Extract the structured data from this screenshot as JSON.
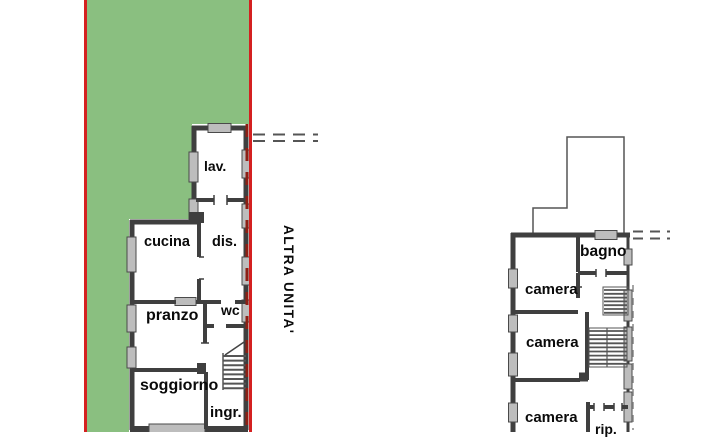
{
  "scene": {
    "description": "real-estate cadastral floor plan drawing, two storeys",
    "colors": {
      "parcel_green": "#8abf80",
      "boundary_red": "#d42020",
      "boundary_dashes_dark_red": "#8b2015",
      "wall_dark": "#3f3f3f",
      "window_gray": "#bdbdbd",
      "stair_hatch_gray": "#555555",
      "label_black": "#0a0a0a"
    }
  },
  "annotations": {
    "other_unit_label": "ALTRA UNITA'"
  },
  "plans": [
    {
      "name": "ground-floor-plan",
      "rooms": [
        {
          "label": "lav."
        },
        {
          "label": "cucina"
        },
        {
          "label": "dis."
        },
        {
          "label": "pranzo"
        },
        {
          "label": "wc"
        },
        {
          "label": "soggiorno"
        },
        {
          "label": "ingr."
        }
      ]
    },
    {
      "name": "first-floor-plan",
      "rooms": [
        {
          "label": "bagno"
        },
        {
          "label": "camera"
        },
        {
          "label": "camera"
        },
        {
          "label": "camera"
        },
        {
          "label": "rip."
        }
      ]
    }
  ]
}
